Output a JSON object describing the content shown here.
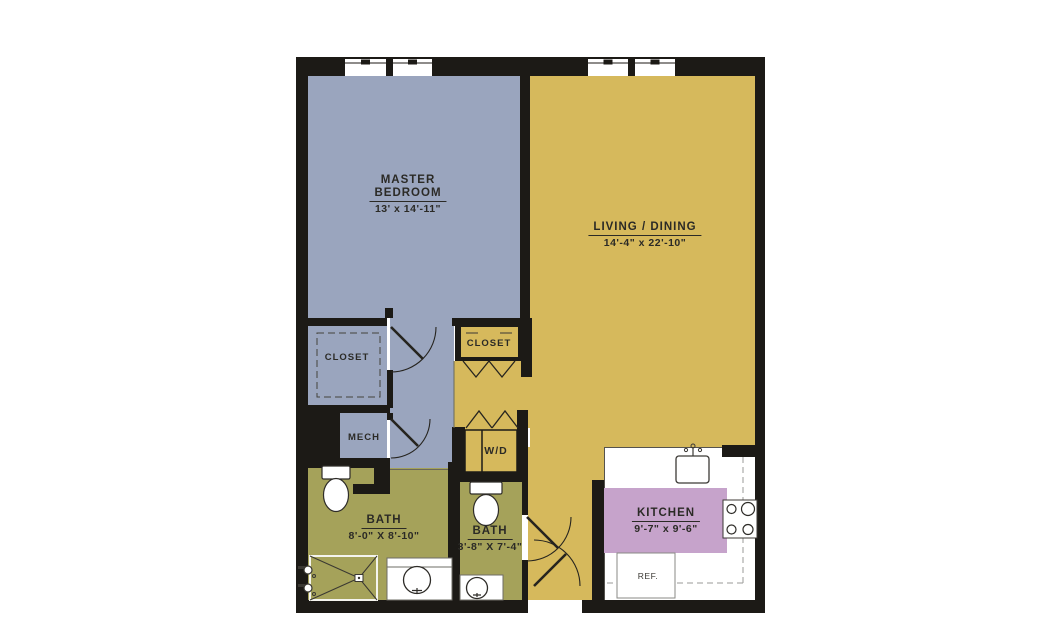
{
  "plan_title": "apartment floor plan",
  "rooms": {
    "master_bedroom": {
      "label_line1": "MASTER",
      "label_line2": "BEDROOM",
      "dims": "13' x 14'-11\""
    },
    "living_dining": {
      "label": "LIVING / DINING",
      "dims": "14'-4\" x 22'-10\""
    },
    "kitchen": {
      "label": "KITCHEN",
      "dims": "9'-7\" x 9'-6\""
    },
    "bath_1": {
      "label": "BATH",
      "dims": "8'-0\" X 8'-10\""
    },
    "bath_2": {
      "label": "BATH",
      "dims": "3'-8\" X 7'-4\""
    },
    "closet_1": {
      "label": "CLOSET"
    },
    "closet_2": {
      "label": "CLOSET"
    },
    "mech": {
      "label": "MECH"
    },
    "washer_dryer": {
      "label": "W/D"
    },
    "refrigerator": {
      "label": "REF."
    }
  },
  "colors": {
    "wall": "#1c1a16",
    "bedroom_zone": "#9aa5be",
    "living_zone": "#d6b95c",
    "bath_zone": "#a5a25a",
    "kitchen_zone": "#c6a3cb",
    "counter": "#ffffff",
    "background": "#ffffff",
    "label_text": "#2b2a26"
  }
}
